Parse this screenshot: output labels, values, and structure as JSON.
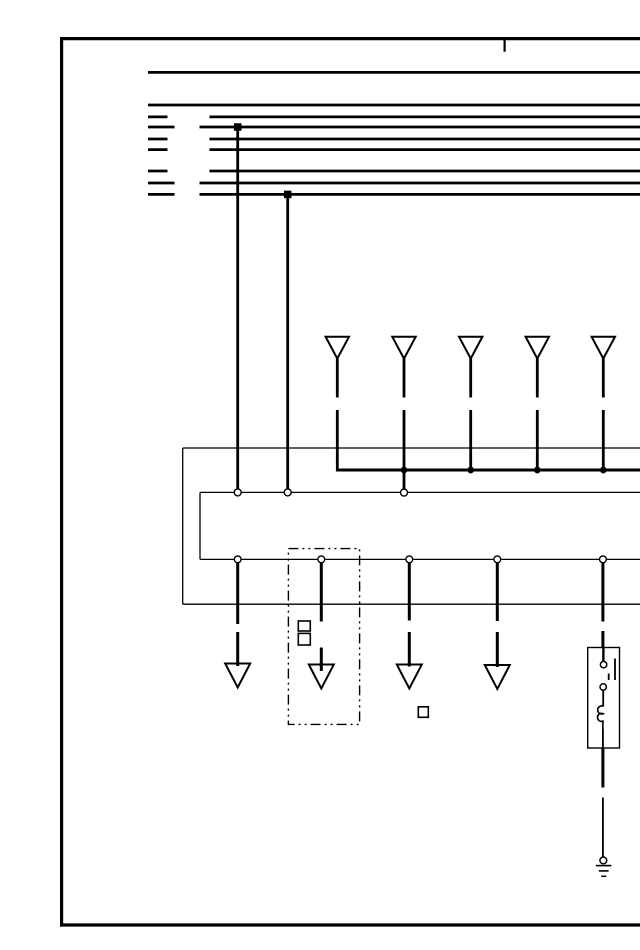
{
  "meta": {
    "bg": "#ffffff",
    "ink": "#000000",
    "width": 640,
    "height": 950
  },
  "shapes": [
    {
      "type": "line",
      "name": "frame-border-top",
      "x1": 60,
      "y1": 38.6,
      "x2": 640,
      "y2": 38.6,
      "w": 3.2
    },
    {
      "type": "line",
      "name": "frame-border-left",
      "x1": 61.6,
      "y1": 37,
      "x2": 61.6,
      "y2": 926.6,
      "w": 3.2
    },
    {
      "type": "line",
      "name": "frame-border-bottom",
      "x1": 60,
      "y1": 925,
      "x2": 640,
      "y2": 925,
      "w": 3.2
    },
    {
      "type": "line",
      "name": "frame-top-tick",
      "x1": 504.6,
      "y1": 40,
      "x2": 504.6,
      "y2": 51.7,
      "w": 2.2
    },
    {
      "type": "line",
      "name": "bus-line-1",
      "x1": 148,
      "y1": 72.4,
      "x2": 640,
      "y2": 72.4,
      "w": 2.8
    },
    {
      "type": "line",
      "name": "bus-line-2",
      "x1": 148,
      "y1": 105,
      "x2": 640,
      "y2": 105,
      "w": 2.8
    },
    {
      "type": "line",
      "name": "bus-line-3-stub",
      "x1": 148,
      "y1": 116.9,
      "x2": 167.5,
      "y2": 116.9,
      "w": 2.8
    },
    {
      "type": "line",
      "name": "bus-line-3",
      "x1": 209.5,
      "y1": 116.9,
      "x2": 640,
      "y2": 116.9,
      "w": 2.8
    },
    {
      "type": "line",
      "name": "bus-line-4-stub",
      "x1": 148,
      "y1": 127,
      "x2": 174.5,
      "y2": 127,
      "w": 2.8
    },
    {
      "type": "line",
      "name": "bus-line-4",
      "x1": 199.5,
      "y1": 127,
      "x2": 640,
      "y2": 127,
      "w": 2.8
    },
    {
      "type": "line",
      "name": "bus-line-5-stub",
      "x1": 148,
      "y1": 139,
      "x2": 167.5,
      "y2": 139,
      "w": 2.8
    },
    {
      "type": "line",
      "name": "bus-line-5",
      "x1": 209.5,
      "y1": 139,
      "x2": 640,
      "y2": 139,
      "w": 2.8
    },
    {
      "type": "line",
      "name": "bus-line-6-stub",
      "x1": 148,
      "y1": 149.6,
      "x2": 167.5,
      "y2": 149.6,
      "w": 2.8
    },
    {
      "type": "line",
      "name": "bus-line-6",
      "x1": 209.5,
      "y1": 149.6,
      "x2": 640,
      "y2": 149.6,
      "w": 2.8
    },
    {
      "type": "line",
      "name": "bus-line-7-stub",
      "x1": 148,
      "y1": 171,
      "x2": 167.5,
      "y2": 171,
      "w": 2.8
    },
    {
      "type": "line",
      "name": "bus-line-7",
      "x1": 209.5,
      "y1": 171,
      "x2": 640,
      "y2": 171,
      "w": 2.8
    },
    {
      "type": "line",
      "name": "bus-line-8-stub",
      "x1": 148,
      "y1": 183,
      "x2": 174.5,
      "y2": 183,
      "w": 2.8
    },
    {
      "type": "line",
      "name": "bus-line-8",
      "x1": 199.5,
      "y1": 183,
      "x2": 640,
      "y2": 183,
      "w": 2.8
    },
    {
      "type": "line",
      "name": "bus-line-9-stub",
      "x1": 148,
      "y1": 194.4,
      "x2": 174.5,
      "y2": 194.4,
      "w": 2.8
    },
    {
      "type": "line",
      "name": "bus-line-9",
      "x1": 199.5,
      "y1": 194.4,
      "x2": 640,
      "y2": 194.4,
      "w": 2.8
    },
    {
      "type": "rect",
      "name": "junction-dot-bus4",
      "x": 234.2,
      "y": 123.5,
      "wd": 7,
      "ht": 7,
      "fill": "ink",
      "w": 0.5
    },
    {
      "type": "rect",
      "name": "junction-dot-bus9",
      "x": 284.2,
      "y": 190.9,
      "wd": 7,
      "ht": 7,
      "fill": "ink",
      "w": 0.5
    },
    {
      "type": "line",
      "name": "wire-drop-left",
      "x1": 237.7,
      "y1": 127,
      "x2": 237.7,
      "y2": 488.8,
      "w": 2.8
    },
    {
      "type": "line",
      "name": "wire-drop-right",
      "x1": 287.7,
      "y1": 194.4,
      "x2": 287.7,
      "y2": 488.8,
      "w": 2.8
    },
    {
      "type": "line",
      "name": "module-box-top",
      "x1": 182.7,
      "y1": 448,
      "x2": 640,
      "y2": 448,
      "w": 1.3
    },
    {
      "type": "line",
      "name": "module-box-left",
      "x1": 182.7,
      "y1": 448,
      "x2": 182.7,
      "y2": 604.2,
      "w": 1.3
    },
    {
      "type": "line",
      "name": "module-box-bottom",
      "x1": 182.7,
      "y1": 604.2,
      "x2": 640,
      "y2": 604.2,
      "w": 1.3
    },
    {
      "type": "poly",
      "name": "connector-arrow-1",
      "pts": "325.6,336.7 349,336.7 337.3,358.6",
      "w": 2
    },
    {
      "type": "line",
      "name": "connector-wire-1a",
      "x1": 337.3,
      "y1": 358.6,
      "x2": 337.3,
      "y2": 397.5,
      "w": 2.8
    },
    {
      "type": "line",
      "name": "connector-wire-1b",
      "x1": 337.3,
      "y1": 410,
      "x2": 337.3,
      "y2": 471.3,
      "w": 2.8
    },
    {
      "type": "poly",
      "name": "connector-arrow-2",
      "pts": "392.3,336.7 415.7,336.7 404,358.6",
      "w": 2
    },
    {
      "type": "line",
      "name": "connector-wire-2a",
      "x1": 404,
      "y1": 358.6,
      "x2": 404,
      "y2": 397.5,
      "w": 2.8
    },
    {
      "type": "line",
      "name": "connector-wire-2b",
      "x1": 404,
      "y1": 410,
      "x2": 404,
      "y2": 489,
      "w": 2.8
    },
    {
      "type": "poly",
      "name": "connector-arrow-3",
      "pts": "459,336.7 482.4,336.7 470.7,358.6",
      "w": 2
    },
    {
      "type": "line",
      "name": "connector-wire-3a",
      "x1": 470.7,
      "y1": 358.6,
      "x2": 470.7,
      "y2": 397.5,
      "w": 2.8
    },
    {
      "type": "line",
      "name": "connector-wire-3b",
      "x1": 470.7,
      "y1": 410,
      "x2": 470.7,
      "y2": 470,
      "w": 2.8
    },
    {
      "type": "poly",
      "name": "connector-arrow-4",
      "pts": "525.6,336.7 549,336.7 537.3,358.6",
      "w": 2
    },
    {
      "type": "line",
      "name": "connector-wire-4a",
      "x1": 537.3,
      "y1": 358.6,
      "x2": 537.3,
      "y2": 397.5,
      "w": 2.8
    },
    {
      "type": "line",
      "name": "connector-wire-4b",
      "x1": 537.3,
      "y1": 410,
      "x2": 537.3,
      "y2": 470,
      "w": 2.8
    },
    {
      "type": "poly",
      "name": "connector-arrow-5",
      "pts": "591.6,336.7 615,336.7 603.3,358.6",
      "w": 2
    },
    {
      "type": "line",
      "name": "connector-wire-5a",
      "x1": 603.3,
      "y1": 358.6,
      "x2": 603.3,
      "y2": 397.5,
      "w": 2.8
    },
    {
      "type": "line",
      "name": "connector-wire-5b",
      "x1": 603.3,
      "y1": 410,
      "x2": 603.3,
      "y2": 470,
      "w": 2.8
    },
    {
      "type": "line",
      "name": "power-bus",
      "x1": 336,
      "y1": 470,
      "x2": 640,
      "y2": 470,
      "w": 3
    },
    {
      "type": "circle",
      "name": "junction-dot-bus-1",
      "cx": 404,
      "cy": 470,
      "r": 3.2,
      "fill": "ink",
      "w": 0.5
    },
    {
      "type": "circle",
      "name": "junction-dot-bus-2",
      "cx": 470.7,
      "cy": 470,
      "r": 3.2,
      "fill": "ink",
      "w": 0.5
    },
    {
      "type": "circle",
      "name": "junction-dot-bus-3",
      "cx": 537.3,
      "cy": 470,
      "r": 3.2,
      "fill": "ink",
      "w": 0.5
    },
    {
      "type": "circle",
      "name": "junction-dot-bus-4",
      "cx": 603.3,
      "cy": 470,
      "r": 3.2,
      "fill": "ink",
      "w": 0.5
    },
    {
      "type": "line",
      "name": "connector-row-1",
      "x1": 200,
      "y1": 492.4,
      "x2": 640,
      "y2": 492.4,
      "w": 1.3
    },
    {
      "type": "line",
      "name": "connector-row-link",
      "x1": 200,
      "y1": 492.4,
      "x2": 200,
      "y2": 559.4,
      "w": 1.3
    },
    {
      "type": "line",
      "name": "connector-row-2",
      "x1": 200,
      "y1": 559.4,
      "x2": 640,
      "y2": 559.4,
      "w": 1.3
    },
    {
      "type": "rect",
      "name": "component-dashed-box",
      "x": 288.4,
      "y": 548.6,
      "wd": 71.2,
      "ht": 175.8,
      "w": 1.4,
      "dash": "10 4 2 4 2 4"
    },
    {
      "type": "rect",
      "name": "small-square-1",
      "x": 298.3,
      "y": 621,
      "wd": 12,
      "ht": 10,
      "w": 1.6
    },
    {
      "type": "rect",
      "name": "small-square-2",
      "x": 298.3,
      "y": 633.4,
      "wd": 12,
      "ht": 11.6,
      "w": 1.6
    },
    {
      "type": "rect",
      "name": "small-square-3",
      "x": 418.3,
      "y": 706.8,
      "wd": 10,
      "ht": 10.5,
      "w": 1.6
    },
    {
      "type": "line",
      "name": "ground-drop-1a",
      "x1": 237.7,
      "y1": 562.8,
      "x2": 237.7,
      "y2": 624,
      "w": 3
    },
    {
      "type": "line",
      "name": "ground-drop-1b",
      "x1": 237.7,
      "y1": 632,
      "x2": 237.7,
      "y2": 666,
      "w": 3
    },
    {
      "type": "line",
      "name": "ground-drop-2a",
      "x1": 321.3,
      "y1": 562.8,
      "x2": 321.3,
      "y2": 621.5,
      "w": 3
    },
    {
      "type": "line",
      "name": "ground-drop-2b",
      "x1": 321.3,
      "y1": 647.5,
      "x2": 321.3,
      "y2": 671,
      "w": 3
    },
    {
      "type": "line",
      "name": "ground-drop-3a",
      "x1": 409.3,
      "y1": 562.8,
      "x2": 409.3,
      "y2": 620.5,
      "w": 3
    },
    {
      "type": "line",
      "name": "ground-drop-3b",
      "x1": 409.3,
      "y1": 632,
      "x2": 409.3,
      "y2": 666.5,
      "w": 3
    },
    {
      "type": "line",
      "name": "ground-drop-4a",
      "x1": 497.3,
      "y1": 562.8,
      "x2": 497.3,
      "y2": 621,
      "w": 3
    },
    {
      "type": "line",
      "name": "ground-drop-4b",
      "x1": 497.3,
      "y1": 632,
      "x2": 497.3,
      "y2": 667,
      "w": 3
    },
    {
      "type": "line",
      "name": "relay-drop-a",
      "x1": 602.9,
      "y1": 562.8,
      "x2": 602.9,
      "y2": 621.5,
      "w": 3
    },
    {
      "type": "line",
      "name": "relay-drop-b",
      "x1": 602.9,
      "y1": 631,
      "x2": 602.9,
      "y2": 648,
      "w": 3
    },
    {
      "type": "poly",
      "name": "ground-arrow-1",
      "pts": "225.2,663.5 250.2,663.5 237.7,687.5",
      "w": 2
    },
    {
      "type": "poly",
      "name": "ground-arrow-2",
      "pts": "308.8,664.5 333.8,664.5 321.3,688.5",
      "w": 2
    },
    {
      "type": "poly",
      "name": "ground-arrow-3",
      "pts": "396.8,664.5 421.8,664.5 409.3,688.5",
      "w": 2
    },
    {
      "type": "poly",
      "name": "ground-arrow-4",
      "pts": "484.8,665 509.8,665 497.3,689",
      "w": 2
    },
    {
      "type": "circle",
      "name": "pin-row1-1",
      "cx": 237.7,
      "cy": 492.4,
      "r": 3.5,
      "fill": "bg",
      "w": 1.4
    },
    {
      "type": "circle",
      "name": "pin-row1-2",
      "cx": 287.7,
      "cy": 492.4,
      "r": 3.5,
      "fill": "bg",
      "w": 1.4
    },
    {
      "type": "circle",
      "name": "pin-row1-3",
      "cx": 404,
      "cy": 492.6,
      "r": 3.5,
      "fill": "bg",
      "w": 1.4
    },
    {
      "type": "circle",
      "name": "pin-row2-1",
      "cx": 237.7,
      "cy": 559.3,
      "r": 3.4,
      "fill": "bg",
      "w": 1.4
    },
    {
      "type": "circle",
      "name": "pin-row2-2",
      "cx": 321.3,
      "cy": 559.3,
      "r": 3.4,
      "fill": "bg",
      "w": 1.4
    },
    {
      "type": "circle",
      "name": "pin-row2-3",
      "cx": 409.3,
      "cy": 559.3,
      "r": 3.4,
      "fill": "bg",
      "w": 1.4
    },
    {
      "type": "circle",
      "name": "pin-row2-4",
      "cx": 497.3,
      "cy": 559.3,
      "r": 3.4,
      "fill": "bg",
      "w": 1.4
    },
    {
      "type": "circle",
      "name": "pin-row2-5",
      "cx": 602.9,
      "cy": 559.3,
      "r": 3.4,
      "fill": "bg",
      "w": 1.4
    },
    {
      "type": "rect",
      "name": "relay-box",
      "x": 587.7,
      "y": 647.5,
      "wd": 31.8,
      "ht": 100.5,
      "w": 1.4
    },
    {
      "type": "line",
      "name": "relay-wire-top",
      "x1": 603.4,
      "y1": 648,
      "x2": 603.4,
      "y2": 661.4,
      "w": 2.4
    },
    {
      "type": "circle",
      "name": "relay-contact-top",
      "cx": 603.6,
      "cy": 664.6,
      "r": 3.2,
      "fill": "bg",
      "w": 1.5
    },
    {
      "type": "circle",
      "name": "relay-contact-bottom",
      "cx": 603.2,
      "cy": 687,
      "r": 3.2,
      "fill": "bg",
      "w": 1.5
    },
    {
      "type": "line",
      "name": "relay-switch-bar",
      "x1": 615,
      "y1": 658.5,
      "x2": 615,
      "y2": 680,
      "w": 1.8
    },
    {
      "type": "line",
      "name": "relay-switch-dash",
      "x1": 608.7,
      "y1": 673.5,
      "x2": 608.7,
      "y2": 680,
      "w": 1.8
    },
    {
      "type": "line",
      "name": "relay-wire-mid",
      "x1": 603.2,
      "y1": 690.2,
      "x2": 603.2,
      "y2": 706.5,
      "w": 1.8
    },
    {
      "type": "path",
      "name": "relay-coil",
      "d": "M603.3,706.3 a4,4 0 1 0 -0.2,7.4 a4,4 0 1 0 -0.2,7.4 L602.8,729.5",
      "w": 1.6
    },
    {
      "type": "line",
      "name": "relay-wire-bottom",
      "x1": 602.9,
      "y1": 729.5,
      "x2": 602.9,
      "y2": 748,
      "w": 1.8
    },
    {
      "type": "line",
      "name": "ground-wire-a",
      "x1": 602.9,
      "y1": 748,
      "x2": 602.9,
      "y2": 787.5,
      "w": 3
    },
    {
      "type": "line",
      "name": "ground-wire-b",
      "x1": 602.9,
      "y1": 797.5,
      "x2": 602.9,
      "y2": 857,
      "w": 1.8
    },
    {
      "type": "circle",
      "name": "ground-terminal",
      "cx": 603.3,
      "cy": 860.4,
      "r": 3.4,
      "fill": "bg",
      "w": 1.5
    },
    {
      "type": "line",
      "name": "ground-bar-1",
      "x1": 595.8,
      "y1": 865.6,
      "x2": 611.3,
      "y2": 865.6,
      "w": 1.6
    },
    {
      "type": "line",
      "name": "ground-bar-2",
      "x1": 598.8,
      "y1": 870.9,
      "x2": 608.6,
      "y2": 870.9,
      "w": 1.6
    },
    {
      "type": "line",
      "name": "ground-bar-3",
      "x1": 601.3,
      "y1": 876.3,
      "x2": 606.3,
      "y2": 876.3,
      "w": 1.6
    }
  ]
}
